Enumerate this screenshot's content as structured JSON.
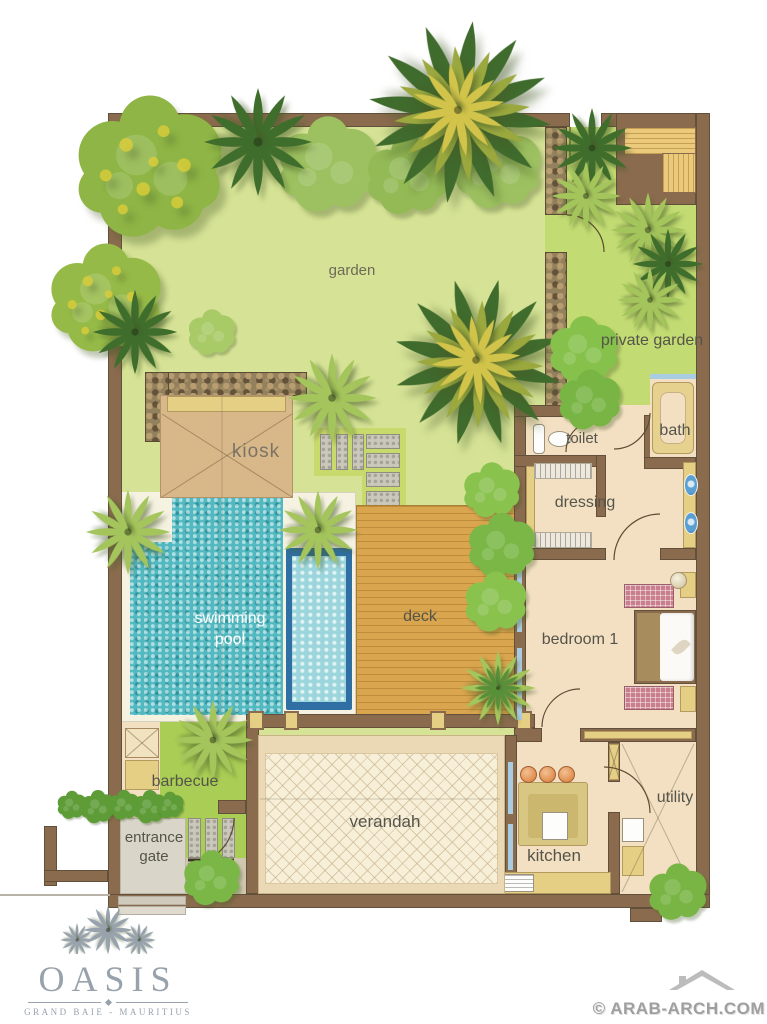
{
  "plan_labels": {
    "garden": "garden",
    "private_garden": "private garden",
    "kiosk": "kiosk",
    "toilet": "toilet",
    "bath": "bath",
    "dressing": "dressing",
    "swimming_pool": "swimming pool",
    "deck": "deck",
    "bedroom_1": "bedroom 1",
    "barbecue": "barbecue",
    "entrance_gate": "entrance gate",
    "verandah": "verandah",
    "kitchen": "kitchen",
    "utility": "utility"
  },
  "branding": {
    "name": "OASIS",
    "location": "GRAND BAIE - MAURITIUS"
  },
  "watermark": {
    "text": "© ARAB-ARCH.COM"
  },
  "palette": {
    "wall": "#8a6b4d",
    "wall_dark": "#63503a",
    "garden": "#d6e396",
    "private_garden": "#c2db72",
    "courtyard": "#a9cd55",
    "room_floor": "#f3e0c2",
    "verandah_floor": "#f8efd9",
    "deck_wood": "#d9a54e",
    "deck_wood_line": "#bf8c3a",
    "pool_water": "#52b9c1",
    "pool_light": "#9cd6dc",
    "pool_wall": "#2f6fa3",
    "pool_deck": "#f6f2e2",
    "stone": "#93805c",
    "paver": "#cac7bb",
    "accent_yellow": "#e4cf85",
    "pink": "#c9808c",
    "basin_blue": "#5a9fd4",
    "stool_orange": "#e08e4f",
    "window_blue": "#a9cce2",
    "hedge_green": "#76b245",
    "palm_dark": "#3e6d2c",
    "palm_light": "#a4c45c",
    "label": "#55544a",
    "label_light": "#7b7365",
    "logo": "#98a2ac",
    "watermark": "#8f8f8f"
  }
}
